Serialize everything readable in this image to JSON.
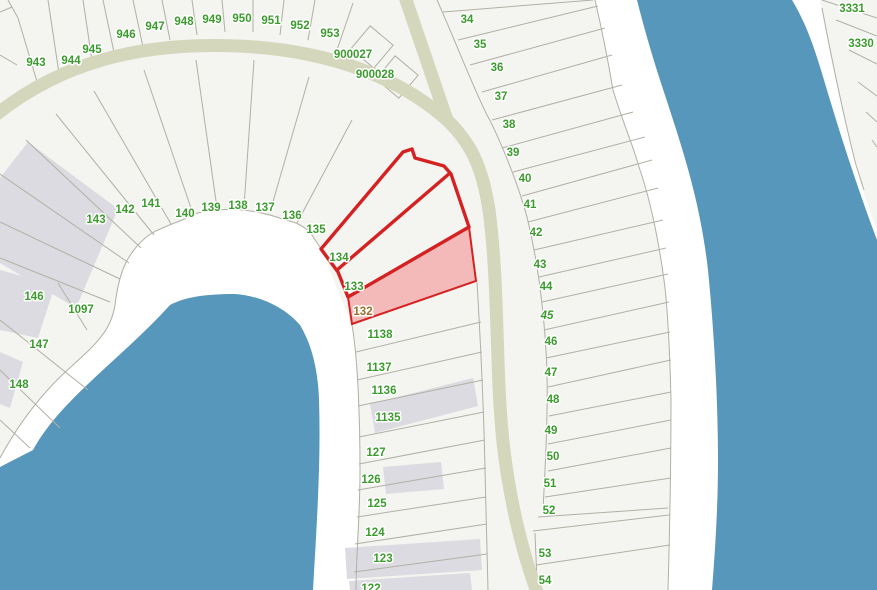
{
  "map": {
    "type": "cadastral-parcel-map",
    "colors": {
      "land": "#f4f4f1",
      "shoreline_band": "#ffffff",
      "water": "#5697bb",
      "road": "#d5d7bc",
      "parcel_line": "#b1b0a5",
      "building": "#dbdbe1",
      "label_green": "#3b9c2d",
      "label_selected": "#99702b",
      "selection_outline": "#d42222",
      "selection_fill": "#f4b9b9"
    },
    "selection": {
      "outlined_parcels": [
        "134",
        "133"
      ],
      "highlighted_parcel": "132"
    },
    "labels": [
      {
        "text": "943",
        "x": 36,
        "y": 66
      },
      {
        "text": "944",
        "x": 71,
        "y": 64
      },
      {
        "text": "945",
        "x": 92,
        "y": 53
      },
      {
        "text": "946",
        "x": 126,
        "y": 38
      },
      {
        "text": "947",
        "x": 155,
        "y": 30
      },
      {
        "text": "948",
        "x": 184,
        "y": 25
      },
      {
        "text": "949",
        "x": 212,
        "y": 23
      },
      {
        "text": "950",
        "x": 242,
        "y": 22
      },
      {
        "text": "951",
        "x": 271,
        "y": 24
      },
      {
        "text": "952",
        "x": 300,
        "y": 29
      },
      {
        "text": "953",
        "x": 330,
        "y": 37
      },
      {
        "text": "900027",
        "x": 353,
        "y": 58
      },
      {
        "text": "900028",
        "x": 375,
        "y": 78
      },
      {
        "text": "3331",
        "x": 852,
        "y": 12
      },
      {
        "text": "3330",
        "x": 861,
        "y": 47
      },
      {
        "text": "143",
        "x": 96,
        "y": 223
      },
      {
        "text": "142",
        "x": 125,
        "y": 213
      },
      {
        "text": "141",
        "x": 151,
        "y": 207
      },
      {
        "text": "140",
        "x": 185,
        "y": 217
      },
      {
        "text": "139",
        "x": 211,
        "y": 211
      },
      {
        "text": "138",
        "x": 238,
        "y": 209
      },
      {
        "text": "137",
        "x": 265,
        "y": 211
      },
      {
        "text": "136",
        "x": 292,
        "y": 219
      },
      {
        "text": "135",
        "x": 316,
        "y": 233
      },
      {
        "text": "134",
        "x": 339,
        "y": 261
      },
      {
        "text": "133",
        "x": 354,
        "y": 290
      },
      {
        "text": "132",
        "x": 363,
        "y": 315,
        "selected": true
      },
      {
        "text": "146",
        "x": 34,
        "y": 300
      },
      {
        "text": "1097",
        "x": 81,
        "y": 313
      },
      {
        "text": "147",
        "x": 39,
        "y": 348
      },
      {
        "text": "148",
        "x": 19,
        "y": 388
      },
      {
        "text": "1138",
        "x": 380,
        "y": 338
      },
      {
        "text": "1137",
        "x": 379,
        "y": 371
      },
      {
        "text": "1136",
        "x": 384,
        "y": 394
      },
      {
        "text": "1135",
        "x": 388,
        "y": 421
      },
      {
        "text": "127",
        "x": 376,
        "y": 456
      },
      {
        "text": "126",
        "x": 371,
        "y": 483
      },
      {
        "text": "125",
        "x": 377,
        "y": 507
      },
      {
        "text": "124",
        "x": 375,
        "y": 536
      },
      {
        "text": "123",
        "x": 383,
        "y": 562
      },
      {
        "text": "122",
        "x": 371,
        "y": 592
      },
      {
        "text": "34",
        "x": 467,
        "y": 23
      },
      {
        "text": "35",
        "x": 480,
        "y": 48
      },
      {
        "text": "36",
        "x": 497,
        "y": 71
      },
      {
        "text": "37",
        "x": 501,
        "y": 100
      },
      {
        "text": "38",
        "x": 509,
        "y": 128
      },
      {
        "text": "39",
        "x": 513,
        "y": 156
      },
      {
        "text": "40",
        "x": 525,
        "y": 182
      },
      {
        "text": "41",
        "x": 530,
        "y": 208
      },
      {
        "text": "42",
        "x": 536,
        "y": 236
      },
      {
        "text": "43",
        "x": 540,
        "y": 268
      },
      {
        "text": "44",
        "x": 546,
        "y": 290
      },
      {
        "text": "45",
        "x": 547,
        "y": 319,
        "italic": true
      },
      {
        "text": "46",
        "x": 551,
        "y": 345
      },
      {
        "text": "47",
        "x": 551,
        "y": 376
      },
      {
        "text": "48",
        "x": 553,
        "y": 403
      },
      {
        "text": "49",
        "x": 551,
        "y": 434
      },
      {
        "text": "50",
        "x": 553,
        "y": 460
      },
      {
        "text": "51",
        "x": 550,
        "y": 487
      },
      {
        "text": "52",
        "x": 549,
        "y": 514
      },
      {
        "text": "53",
        "x": 545,
        "y": 557
      },
      {
        "text": "54",
        "x": 545,
        "y": 584
      }
    ]
  }
}
